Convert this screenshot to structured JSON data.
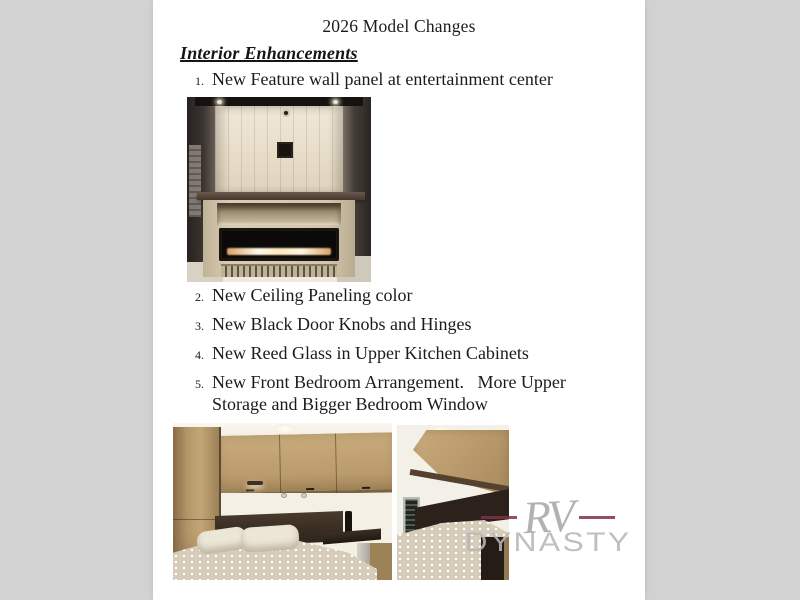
{
  "window": {
    "background_color": "#d2d2d2",
    "page_background_color": "#ffffff"
  },
  "document": {
    "title": "2026 Model Changes",
    "heading": "Interior Enhancements",
    "items": [
      {
        "num": "1.",
        "text": "New Feature wall panel at entertainment center"
      },
      {
        "num": "2.",
        "text": "New Ceiling Paneling color"
      },
      {
        "num": "3.",
        "text": "New Black Door Knobs and Hinges"
      },
      {
        "num": "4.",
        "text": "New Reed Glass in Upper Kitchen Cabinets"
      },
      {
        "num": "5.",
        "text": "New Front Bedroom Arrangement.   More Upper\nStorage and Bigger Bedroom Window"
      }
    ],
    "photos": [
      {
        "name": "entertainment-center-photo",
        "description": "feature wall panel at entertainment center with fireplace"
      },
      {
        "name": "bedroom-left-photo",
        "description": "front bedroom with upper storage cabinets and bed"
      },
      {
        "name": "bedroom-right-photo",
        "description": "front bedroom angle with window and bed"
      }
    ]
  },
  "watermark": {
    "script_text": "RV",
    "main_text": "DYNASTY",
    "dash_color": "#82304a",
    "text_color": "#b6b6b6"
  }
}
